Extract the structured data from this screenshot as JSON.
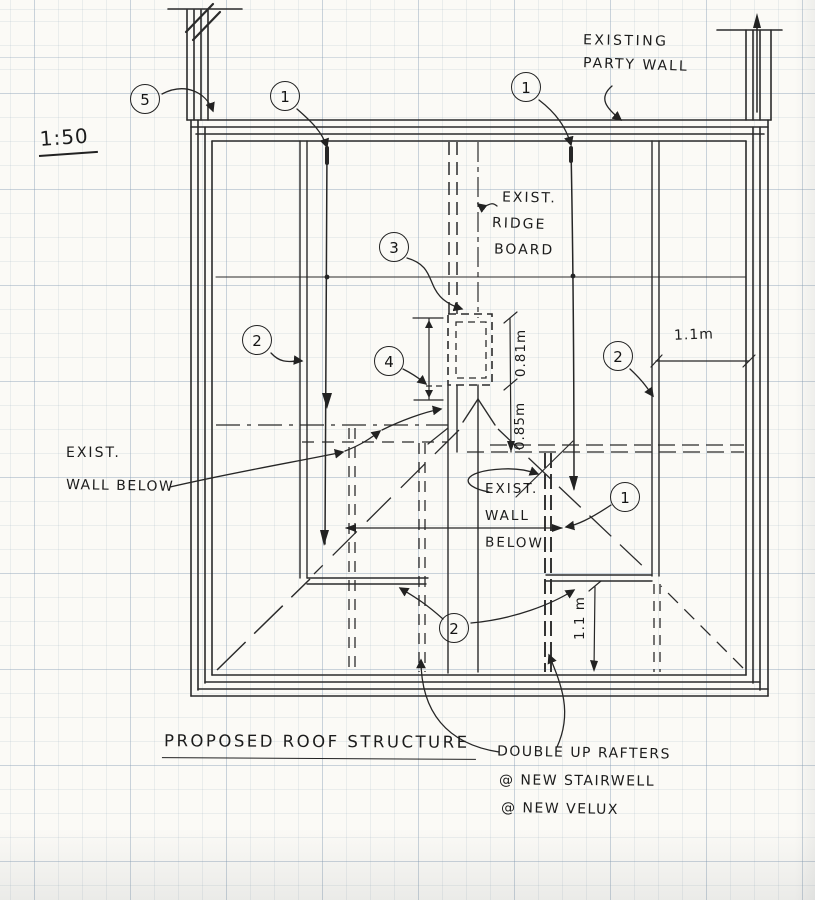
{
  "drawing": {
    "scale": "1:50",
    "title": "PROPOSED ROOF STRUCTURE"
  },
  "labels": {
    "party_wall_1": "EXISTING",
    "party_wall_2": "PARTY WALL",
    "ridge_1": "EXIST.",
    "ridge_2": "RIDGE",
    "ridge_3": "BOARD",
    "wall_below_left_1": "EXIST.",
    "wall_below_left_2": "WALL BELOW",
    "wall_below_mid_1": "EXIST.",
    "wall_below_mid_2": "WALL",
    "wall_below_mid_3": "BELOW",
    "rafters_1": "DOUBLE UP RAFTERS",
    "rafters_2": "@ NEW STAIRWELL",
    "rafters_3": "@ NEW VELUX"
  },
  "dimensions": {
    "eaves_width": "1.1m",
    "velux_upper": "0.81m",
    "velux_lower": "0.85m",
    "stair_right": "1.1 m"
  },
  "callouts": {
    "c5": "5",
    "c1a": "1",
    "c1b": "1",
    "c3": "3",
    "c2a": "2",
    "c4": "4",
    "c2b": "2",
    "c1c": "1",
    "c2c": "2"
  },
  "colors": {
    "ink": "#2a2a2a",
    "paper": "#fbfaf6",
    "grid_line": "#9fb3c8"
  }
}
